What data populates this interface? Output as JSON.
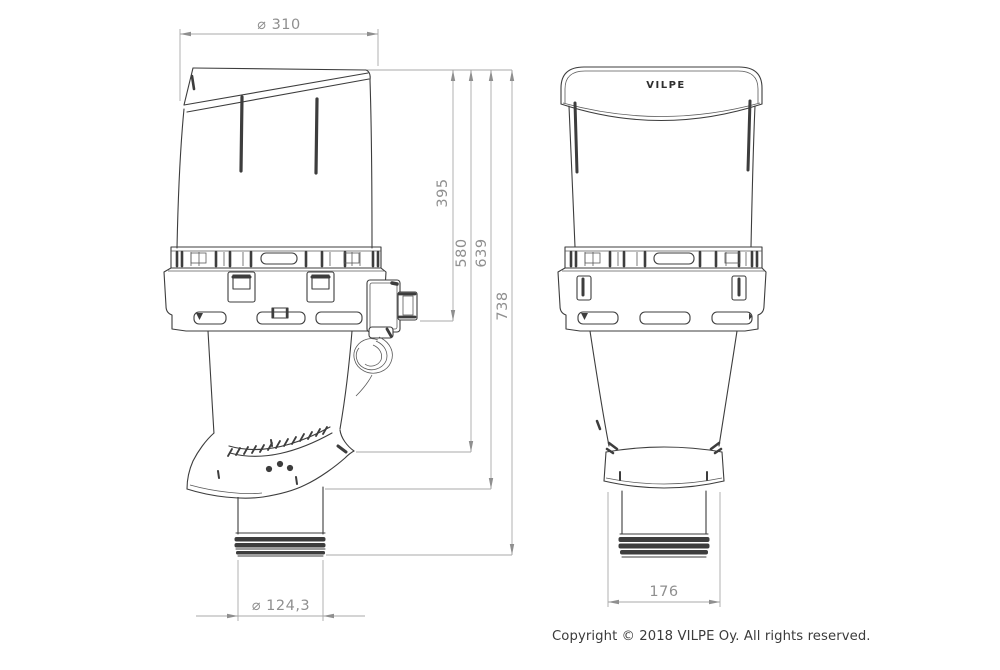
{
  "dims": {
    "cap_diameter": "⌀ 310",
    "height_flange": "395",
    "height_skirt_top": "580",
    "height_skirt_bottom": "639",
    "height_total": "738",
    "pipe_diameter": "⌀ 124,3",
    "base_width": "176"
  },
  "logo": {
    "text": "VILPE"
  },
  "footer": {
    "copyright": "Copyright © 2018 VILPE Oy. All rights reserved."
  },
  "colors": {
    "outline": "#3d3d3d",
    "dimension_line": "#a8a8a8",
    "dimension_text": "#8f8f8f",
    "background": "#ffffff"
  }
}
